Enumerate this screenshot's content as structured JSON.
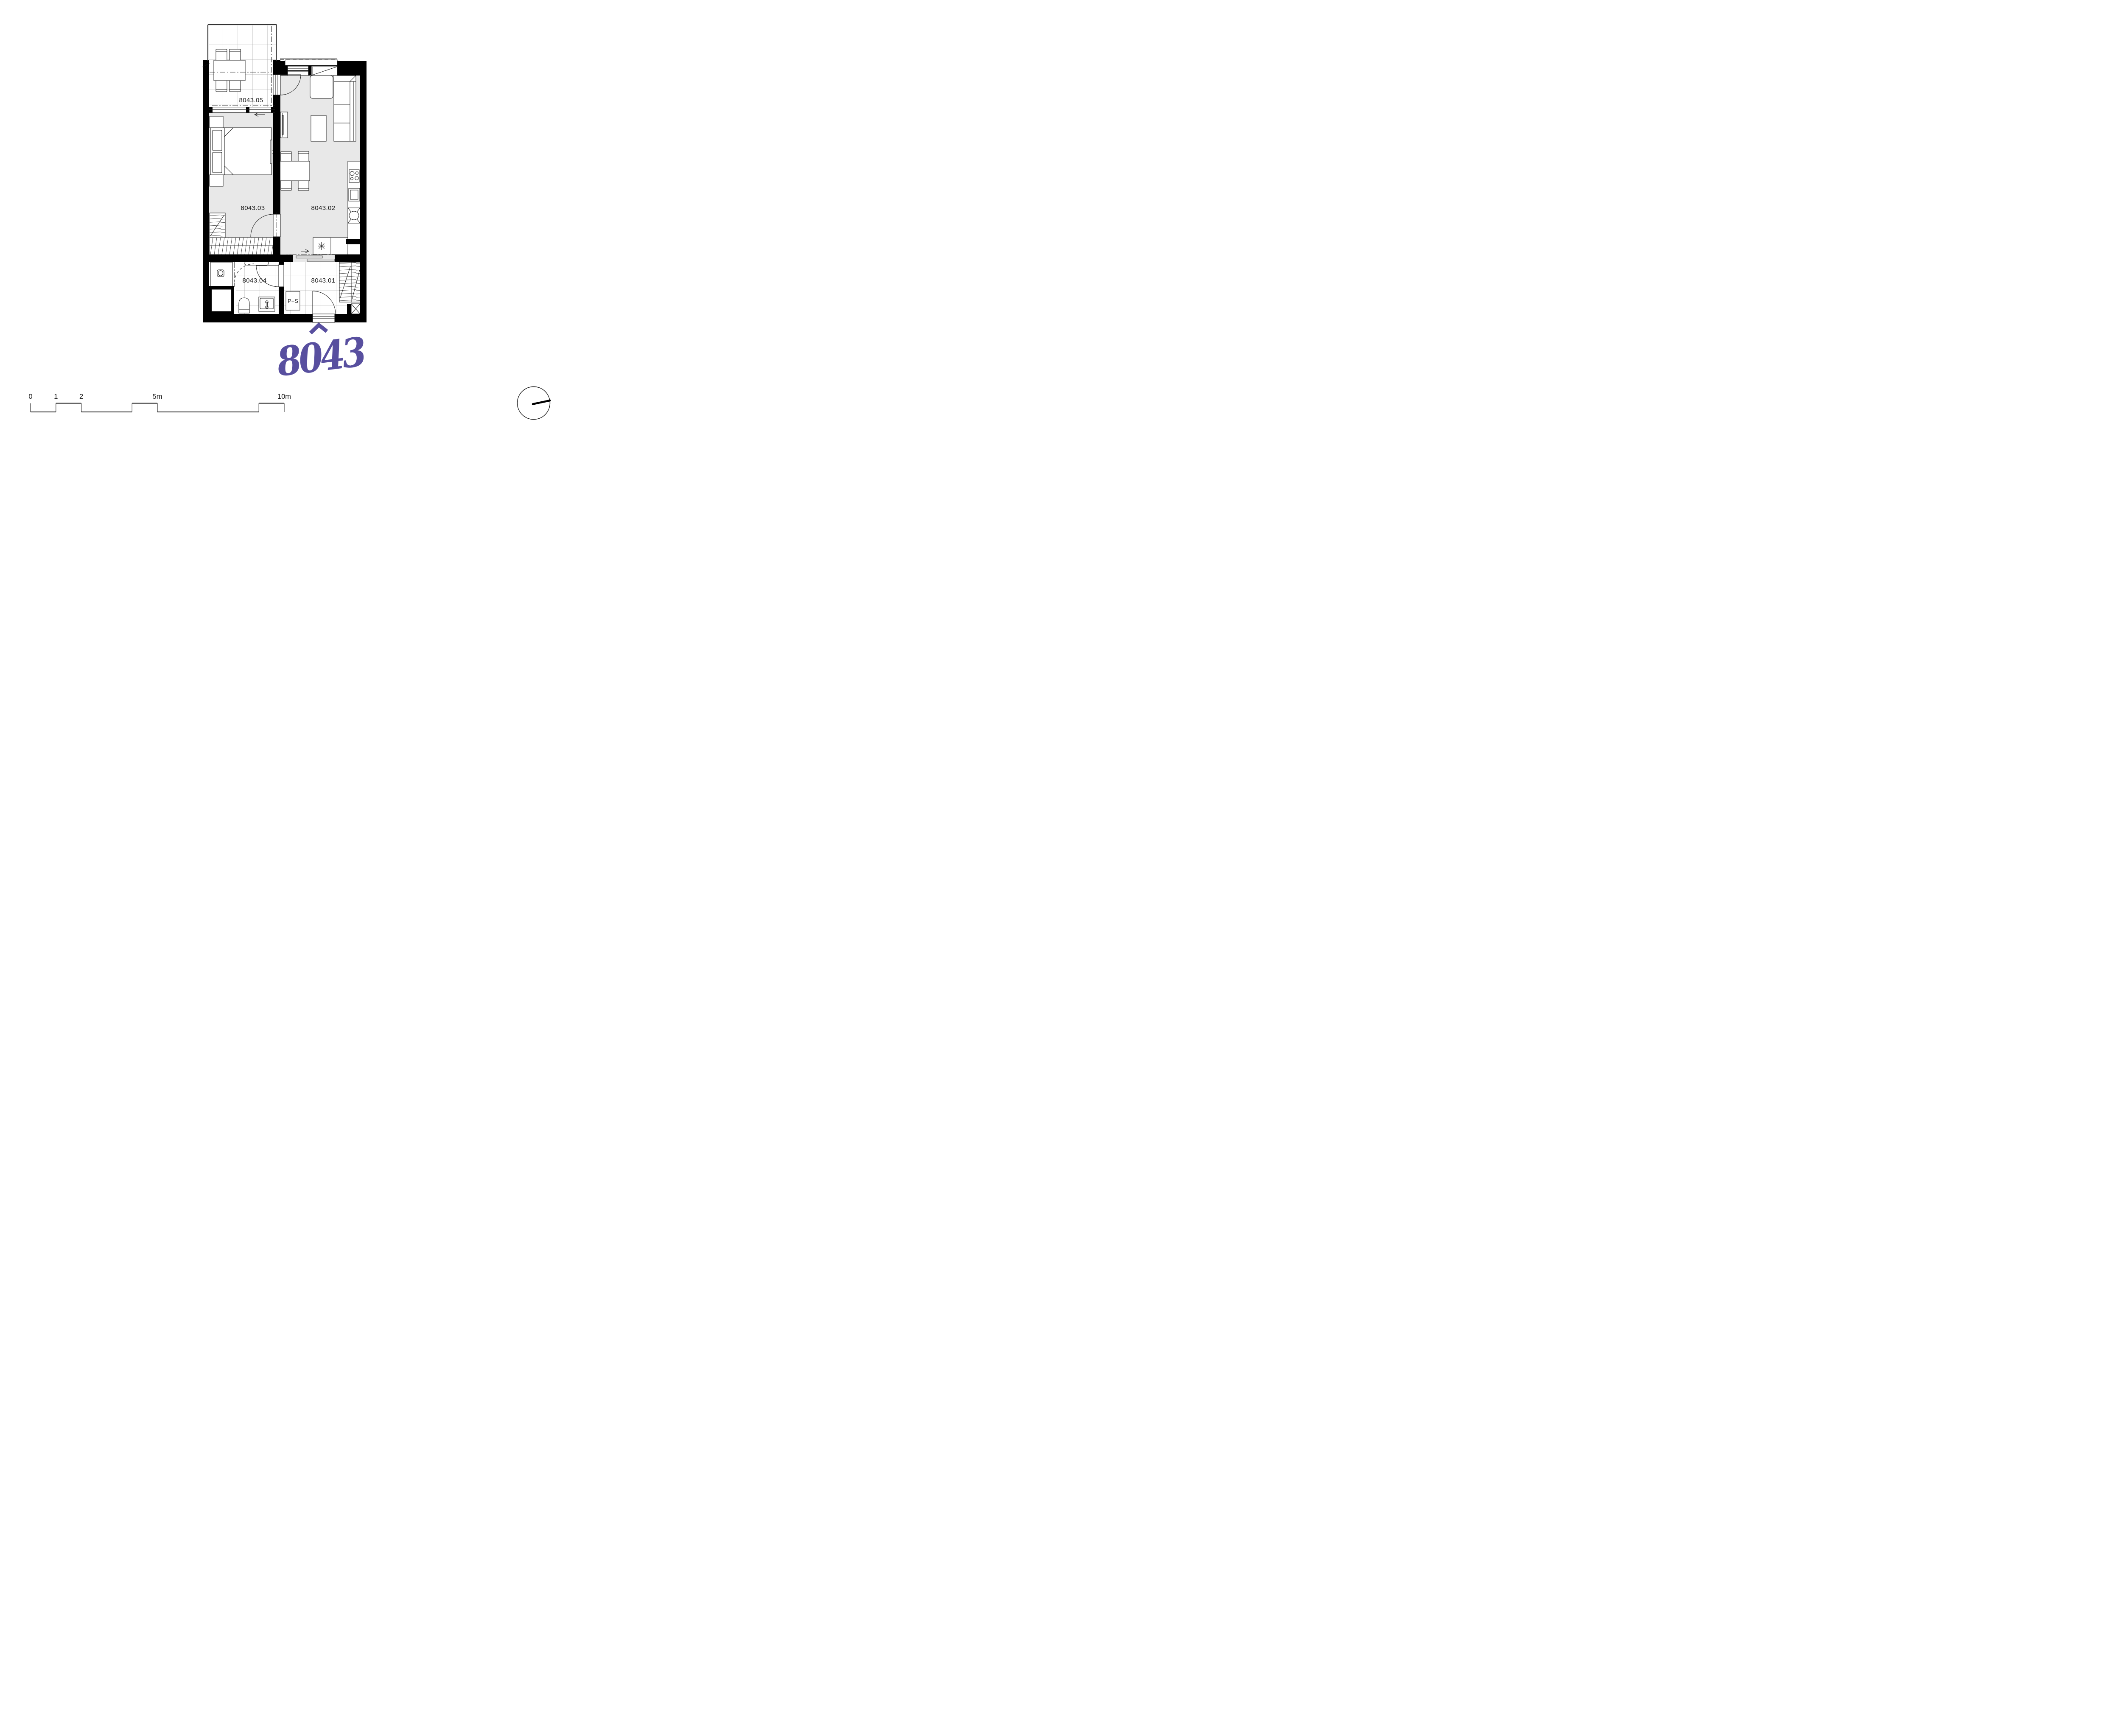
{
  "page": {
    "background": "#ffffff"
  },
  "plan": {
    "unit_number": "8043",
    "accent_color": "#584f9f",
    "floor_color": "#e8e8e8",
    "wall_color": "#000000",
    "rooms": [
      {
        "code": "8043.01",
        "type": "hallway"
      },
      {
        "code": "8043.02",
        "type": "living-room-kitchen"
      },
      {
        "code": "8043.03",
        "type": "bedroom"
      },
      {
        "code": "8043.04",
        "type": "bathroom"
      },
      {
        "code": "8043.05",
        "type": "balcony"
      }
    ],
    "appliance_label": "P+S"
  },
  "scale_bar": {
    "labels": [
      "0",
      "1",
      "2",
      "5m",
      "10m"
    ],
    "positions_m": [
      0,
      1,
      2,
      5,
      10
    ],
    "upper_segments_m": [
      [
        1,
        2
      ],
      [
        4,
        5
      ],
      [
        9,
        10
      ]
    ],
    "lower_segments_m": [
      [
        0,
        1
      ],
      [
        2,
        4
      ],
      [
        5,
        9
      ]
    ]
  },
  "compass": {
    "style": "circle-with-pointer"
  }
}
